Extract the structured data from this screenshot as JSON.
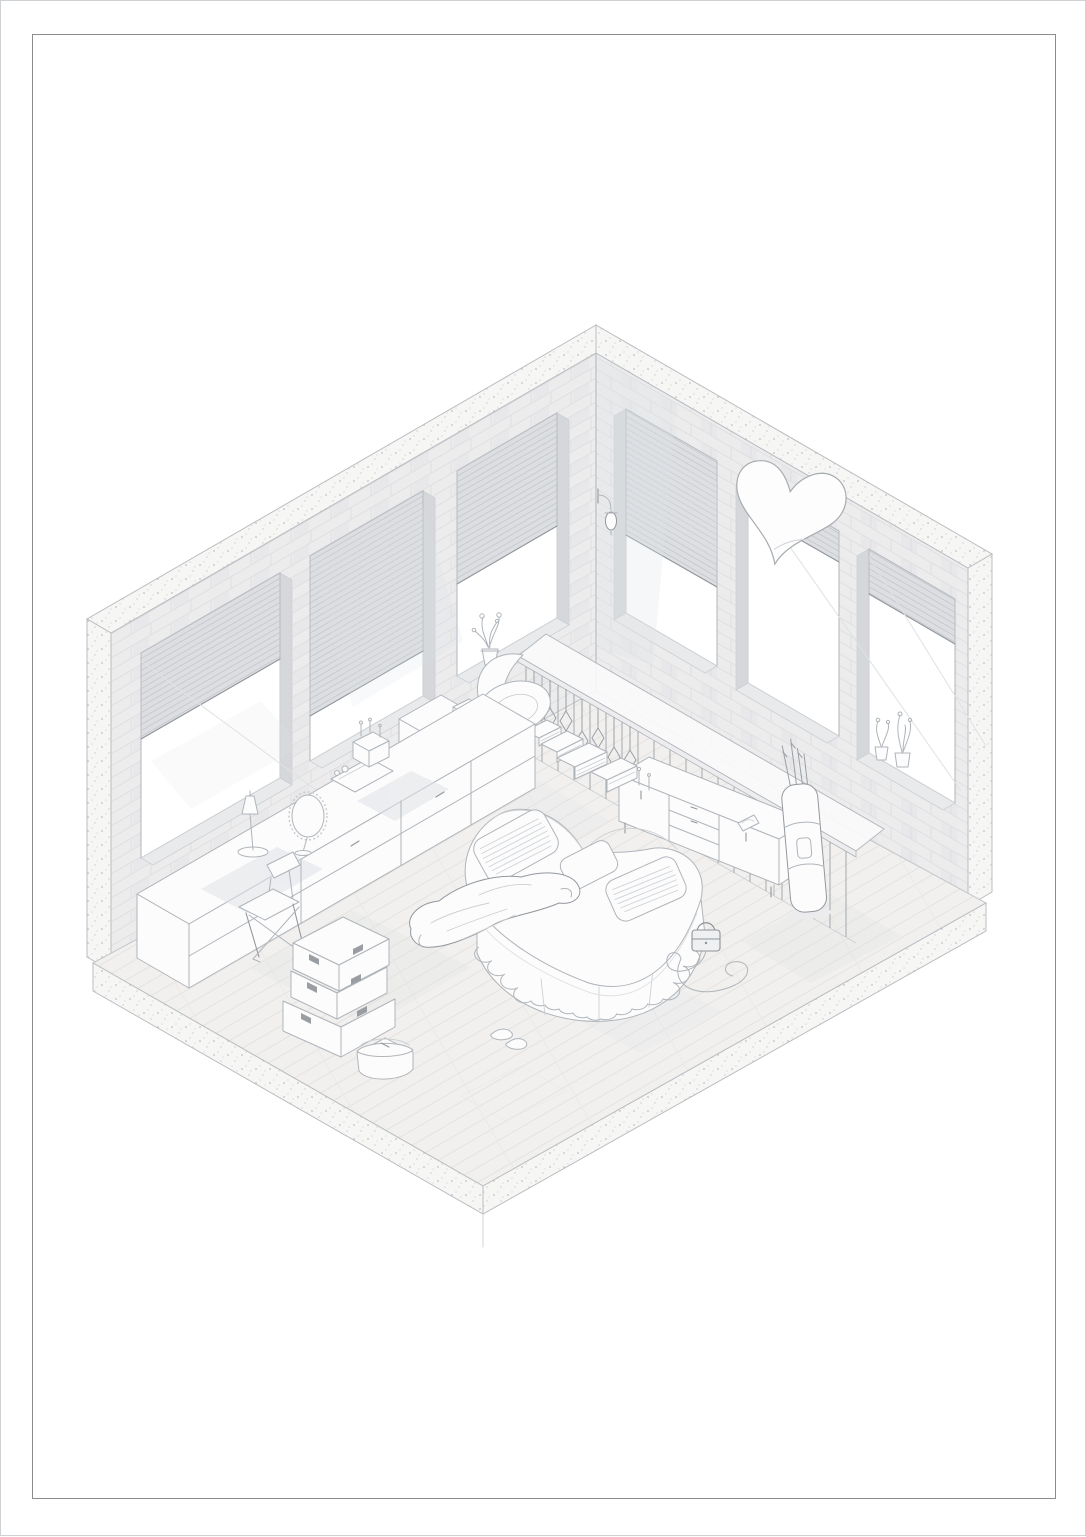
{
  "meta": {
    "description": "Isometric cutaway architectural illustration of a loft bedroom with a heart-shaped bed",
    "style": "very light gray architectural line drawing on a white sheet with thin border frame"
  },
  "frame": {
    "border_color": "#8a8d90",
    "page_edge_color": "#cfd2d5"
  },
  "palette": {
    "page-bg": "#ffffff",
    "frame": "#8a8d90",
    "edge": "#cfd2d5",
    "line-strong": "#93989d",
    "line": "#b0b5ba",
    "line-faint": "#ccd0d3",
    "line-hair": "#dfe1e3",
    "furn": "#fcfcfd",
    "jamb": "#d5d7da",
    "sill": "#e9eaec",
    "shade": "#dfe2e6",
    "glass": "#ffffff",
    "brick": "#ececed",
    "brick-line": "#dedee1",
    "concrete": "#f6f6f5",
    "speckle": "#c2c2c2",
    "blind": "#dcdee1",
    "blind-line": "#c6c9cc",
    "floor": "#f1f0ee",
    "plank-line": "#e4e3e0"
  },
  "scene": {
    "objects": [
      {
        "name": "concrete-cut-band",
        "label": "concrete section cut along wall tops and ends"
      },
      {
        "name": "left-brick-wall",
        "label": "left brick wall with three blinded windows"
      },
      {
        "name": "right-brick-wall",
        "label": "right brick wall with three windows"
      },
      {
        "name": "heart-wall-mirror",
        "label": "tilted heart-shaped mirror on right wall"
      },
      {
        "name": "wall-sconce",
        "label": "lantern wall sconce near room corner"
      },
      {
        "name": "sill-plant-left",
        "label": "potted plant on left window sill"
      },
      {
        "name": "sill-plants-right",
        "label": "two potted plants on right window sill"
      },
      {
        "name": "wood-plank-floor",
        "label": "light wood plank floor on concrete slab"
      },
      {
        "name": "divider-railing",
        "label": "shelf railing with hanging diamond ornaments"
      },
      {
        "name": "tv-sideboard",
        "label": "long low sideboard with doors and drawers"
      },
      {
        "name": "leaning-tall-bag",
        "label": "tall padded bag with sticks leaning on sideboard"
      },
      {
        "name": "papasan-chair",
        "label": "slouchy lounge chair with curled cushion"
      },
      {
        "name": "magazine-stacks",
        "label": "cascading stacks of magazines"
      },
      {
        "name": "open-cardboard-box",
        "label": "open cardboard box"
      },
      {
        "name": "shelf-unit",
        "label": "small open shelf unit on vanity"
      },
      {
        "name": "vanity-counter",
        "label": "long vanity counter along left wall"
      },
      {
        "name": "table-lamp",
        "label": "small table lamp"
      },
      {
        "name": "vanity-mirror",
        "label": "oval scalloped vanity mirror"
      },
      {
        "name": "makeup-set",
        "label": "cosmetics organizers and bottles"
      },
      {
        "name": "folding-chair",
        "label": "folding chair"
      },
      {
        "name": "storage-boxes",
        "label": "three stacked storage boxes"
      },
      {
        "name": "lidded-basket",
        "label": "small lidded basket"
      },
      {
        "name": "heart-bed",
        "label": "heart-shaped bed with scalloped skirt"
      },
      {
        "name": "striped-pillows",
        "label": "striped pillows"
      },
      {
        "name": "draped-robe",
        "label": "robe draped over bed edge"
      },
      {
        "name": "handbag",
        "label": "small dark handbag beside bed"
      },
      {
        "name": "cord-swirl",
        "label": "cord looping on the floor"
      },
      {
        "name": "slippers",
        "label": "pair of slippers in front of bed"
      }
    ]
  }
}
